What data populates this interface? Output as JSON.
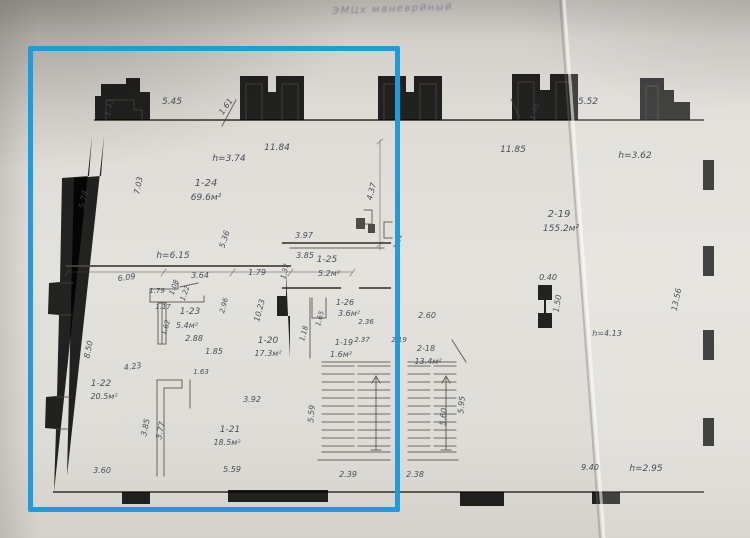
{
  "stamp": {
    "text": "ЭМЦх  маневрйный"
  },
  "selection": {
    "color": "#1f9cdf",
    "x": 28,
    "y": 46,
    "width": 372,
    "height": 466,
    "border": 5
  },
  "plan": {
    "wall_color": "#4b463e",
    "label_color": "#3d4250",
    "rooms": [
      {
        "id": "1-19",
        "area": "1.6м²"
      },
      {
        "id": "1-20",
        "area": "17.3м²"
      },
      {
        "id": "1-21",
        "area": "18.5м²"
      },
      {
        "id": "1-22",
        "area": "20.5м²"
      },
      {
        "id": "1-23",
        "area": "5.4м²"
      },
      {
        "id": "1-24",
        "area": "69.6м²"
      },
      {
        "id": "1-25",
        "area": "5.2м²"
      },
      {
        "id": "1-26",
        "area": "3.6м²"
      },
      {
        "id": "2-18",
        "area": "13.4м²"
      },
      {
        "id": "2-19",
        "area": "155.2м²"
      }
    ],
    "heights": [
      "h=3.74",
      "h=6.15",
      "h=3.62",
      "h=4.13",
      "h=2.95"
    ],
    "labels": [
      {
        "t": "5.45",
        "x": 172,
        "y": 104,
        "s": 9
      },
      {
        "t": "1.43",
        "x": 112,
        "y": 108,
        "r": -75
      },
      {
        "t": "1.61",
        "x": 228,
        "y": 108,
        "r": -55
      },
      {
        "t": "11.84",
        "x": 277,
        "y": 150,
        "s": 9
      },
      {
        "t": "h=3.74",
        "x": 229,
        "y": 161,
        "k": "note",
        "s": 9
      },
      {
        "t": "1-24",
        "x": 206,
        "y": 186,
        "k": "room",
        "s": 10
      },
      {
        "t": "69.6м²",
        "x": 206,
        "y": 200,
        "k": "area",
        "s": 9
      },
      {
        "t": "7.03",
        "x": 141,
        "y": 186,
        "r": -78
      },
      {
        "t": "5.78",
        "x": 86,
        "y": 200,
        "r": -78
      },
      {
        "t": "5.36",
        "x": 227,
        "y": 240,
        "r": -72
      },
      {
        "t": "h=6.15",
        "x": 173,
        "y": 258,
        "k": "note",
        "s": 9
      },
      {
        "t": "6.09",
        "x": 127,
        "y": 280,
        "r": -8
      },
      {
        "t": "3.64",
        "x": 200,
        "y": 278
      },
      {
        "t": "1.79",
        "x": 257,
        "y": 275
      },
      {
        "t": "1.79",
        "x": 157,
        "y": 293,
        "s": 7
      },
      {
        "t": "1.08",
        "x": 176,
        "y": 288,
        "r": -70,
        "s": 7
      },
      {
        "t": "1.22",
        "x": 187,
        "y": 294,
        "r": -70,
        "s": 7
      },
      {
        "t": "1.17",
        "x": 163,
        "y": 309,
        "s": 7
      },
      {
        "t": "1-23",
        "x": 190,
        "y": 314,
        "k": "room",
        "s": 9
      },
      {
        "t": "5.4м²",
        "x": 187,
        "y": 328,
        "k": "area",
        "s": 8
      },
      {
        "t": "1.62",
        "x": 168,
        "y": 328,
        "r": -75,
        "s": 7
      },
      {
        "t": "2.96",
        "x": 226,
        "y": 306,
        "r": -75,
        "s": 7
      },
      {
        "t": "2.88",
        "x": 194,
        "y": 341
      },
      {
        "t": "1.85",
        "x": 214,
        "y": 354
      },
      {
        "t": "10.23",
        "x": 262,
        "y": 311,
        "r": -75
      },
      {
        "t": "1-20",
        "x": 268,
        "y": 343,
        "k": "room",
        "s": 9
      },
      {
        "t": "17.3м²",
        "x": 268,
        "y": 356,
        "k": "area",
        "s": 8
      },
      {
        "t": "8.50",
        "x": 91,
        "y": 350,
        "r": -78
      },
      {
        "t": "4.23",
        "x": 133,
        "y": 369,
        "r": -8
      },
      {
        "t": "1-22",
        "x": 101,
        "y": 386,
        "k": "room",
        "s": 9
      },
      {
        "t": "20.5м²",
        "x": 104,
        "y": 399,
        "k": "area",
        "s": 8
      },
      {
        "t": "1.63",
        "x": 201,
        "y": 374,
        "s": 7
      },
      {
        "t": "3.85",
        "x": 148,
        "y": 428,
        "r": -78
      },
      {
        "t": "3.77",
        "x": 163,
        "y": 431,
        "r": -78
      },
      {
        "t": "3.92",
        "x": 252,
        "y": 402
      },
      {
        "t": "1-21",
        "x": 230,
        "y": 432,
        "k": "room",
        "s": 9
      },
      {
        "t": "18.5м²",
        "x": 227,
        "y": 445,
        "k": "area",
        "s": 8
      },
      {
        "t": "3.60",
        "x": 102,
        "y": 473
      },
      {
        "t": "5.59",
        "x": 232,
        "y": 472
      },
      {
        "t": "5.59",
        "x": 314,
        "y": 414,
        "r": -85
      },
      {
        "t": "2.39",
        "x": 348,
        "y": 477
      },
      {
        "t": "3.97",
        "x": 304,
        "y": 238
      },
      {
        "t": "3.85",
        "x": 305,
        "y": 258
      },
      {
        "t": "1-25",
        "x": 327,
        "y": 262,
        "k": "room",
        "s": 9
      },
      {
        "t": "5.2м²",
        "x": 329,
        "y": 276,
        "k": "area",
        "s": 8
      },
      {
        "t": "1.37",
        "x": 287,
        "y": 272,
        "r": -75,
        "s": 7
      },
      {
        "t": "4.37",
        "x": 374,
        "y": 192,
        "r": -75
      },
      {
        "t": "1.61",
        "x": 400,
        "y": 242,
        "r": -75,
        "s": 7
      },
      {
        "t": "1-26",
        "x": 345,
        "y": 305,
        "k": "room",
        "s": 8
      },
      {
        "t": "3.6м²",
        "x": 349,
        "y": 316,
        "k": "area",
        "s": 8
      },
      {
        "t": "1.65",
        "x": 322,
        "y": 319,
        "r": -75,
        "s": 7
      },
      {
        "t": "1.18",
        "x": 306,
        "y": 334,
        "r": -75,
        "s": 7
      },
      {
        "t": "2.36",
        "x": 366,
        "y": 324,
        "s": 7
      },
      {
        "t": "2.37",
        "x": 362,
        "y": 342,
        "s": 7
      },
      {
        "t": "1-19",
        "x": 344,
        "y": 345,
        "k": "room",
        "s": 8
      },
      {
        "t": "1.6м²",
        "x": 341,
        "y": 357,
        "k": "area",
        "s": 8
      },
      {
        "t": "5.52",
        "x": 588,
        "y": 104,
        "s": 9
      },
      {
        "t": "1.46",
        "x": 537,
        "y": 112,
        "r": -75
      },
      {
        "t": "1.48",
        "x": 651,
        "y": 112,
        "r": -75
      },
      {
        "t": "11.85",
        "x": 513,
        "y": 152,
        "s": 9
      },
      {
        "t": "h=3.62",
        "x": 635,
        "y": 158,
        "k": "note",
        "s": 9
      },
      {
        "t": "2-19",
        "x": 559,
        "y": 217,
        "k": "room",
        "s": 10
      },
      {
        "t": "155.2м²",
        "x": 561,
        "y": 231,
        "k": "area",
        "s": 9
      },
      {
        "t": "0.40",
        "x": 548,
        "y": 280
      },
      {
        "t": "1.50",
        "x": 560,
        "y": 304,
        "r": -80
      },
      {
        "t": "13.56",
        "x": 679,
        "y": 300,
        "r": -78
      },
      {
        "t": "h=4.13",
        "x": 607,
        "y": 336,
        "k": "note",
        "s": 8
      },
      {
        "t": "2.60",
        "x": 427,
        "y": 318
      },
      {
        "t": "2.19",
        "x": 399,
        "y": 342,
        "s": 7
      },
      {
        "t": "2-18",
        "x": 426,
        "y": 351,
        "k": "room",
        "s": 8
      },
      {
        "t": "13.4м²",
        "x": 428,
        "y": 364,
        "k": "area",
        "s": 8
      },
      {
        "t": "5.60",
        "x": 446,
        "y": 417,
        "r": -85
      },
      {
        "t": "5.95",
        "x": 464,
        "y": 405,
        "r": -85
      },
      {
        "t": "2.38",
        "x": 415,
        "y": 477
      },
      {
        "t": "9.40",
        "x": 590,
        "y": 470
      },
      {
        "t": "h=2.95",
        "x": 646,
        "y": 471,
        "k": "note",
        "s": 9
      }
    ]
  }
}
